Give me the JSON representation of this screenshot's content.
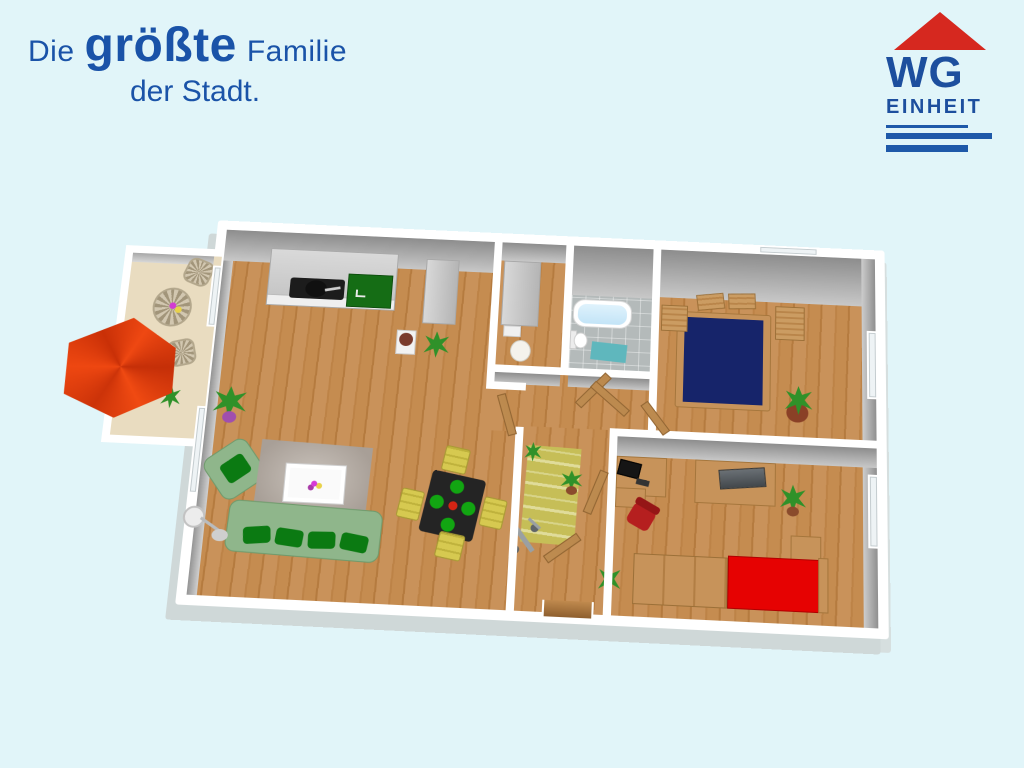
{
  "background_color": "#e1f5f9",
  "slogan": {
    "word1": "Die",
    "word2": "größte",
    "word3": "Familie",
    "line2": "der Stadt.",
    "color": "#1a53a8"
  },
  "logo": {
    "name": "WG",
    "sub": "EINHEIT",
    "roof_color": "#d6281f",
    "text_color": "#1d4f9e",
    "line_color": "#1e59a9"
  },
  "floorplan": {
    "type": "3d-apartment-floorplan",
    "wall_color": "#ffffff",
    "wood_floor_color": "#c28a4c",
    "rooms": [
      {
        "name": "balcony",
        "items": [
          "red-parasol",
          "wicker-table",
          "wicker-chair",
          "wicker-chair",
          "flowers",
          "plant"
        ]
      },
      {
        "name": "living-room-with-open-kitchen",
        "items": [
          "kitchen-counter",
          "black-cooktop",
          "green-sink-counter",
          "tall-cabinet",
          "green-sofa",
          "green-armchair",
          "gray-rug",
          "white-coffee-table",
          "black-dining-table",
          "yellow-chair",
          "yellow-chair",
          "yellow-chair",
          "yellow-chair",
          "floor-lamp",
          "potted-plant",
          "potted-plant"
        ]
      },
      {
        "name": "pantry",
        "items": [
          "tall-cabinet",
          "white-basket"
        ]
      },
      {
        "name": "bathroom",
        "items": [
          "bathtub",
          "toilet",
          "teal-bath-mat"
        ]
      },
      {
        "name": "bedroom",
        "items": [
          "navy-double-bed",
          "headboard-slats",
          "bedside-bench",
          "bedside-bench",
          "potted-plant",
          "window"
        ]
      },
      {
        "name": "office-bedroom",
        "items": [
          "desk",
          "monitor",
          "red-office-chair",
          "sideboard",
          "laptop",
          "wardrobe",
          "red-single-bed",
          "small-cabinet",
          "potted-plant",
          "window"
        ]
      },
      {
        "name": "hallway",
        "items": [
          "striped-rug",
          "open-door",
          "open-door",
          "open-door",
          "open-door",
          "open-door",
          "scooter",
          "potted-plant",
          "entrance-threshold"
        ]
      }
    ],
    "colors": {
      "sofa_green": "#8fb68b",
      "cushion_green": "#0b7a12",
      "navy_bed": "#16246a",
      "red_bed": "#e60202",
      "parasol_red": "#e8380e",
      "bathtub_blue": "#cfeaf9",
      "teal_mat": "#5fb7bd",
      "chair_yellow": "#d6c950",
      "dining_table_black": "#242424",
      "wood_furniture": "#c7935a",
      "hall_rug_olive": "#c6be57",
      "wall_face_gray": "#9a9a9a"
    }
  }
}
